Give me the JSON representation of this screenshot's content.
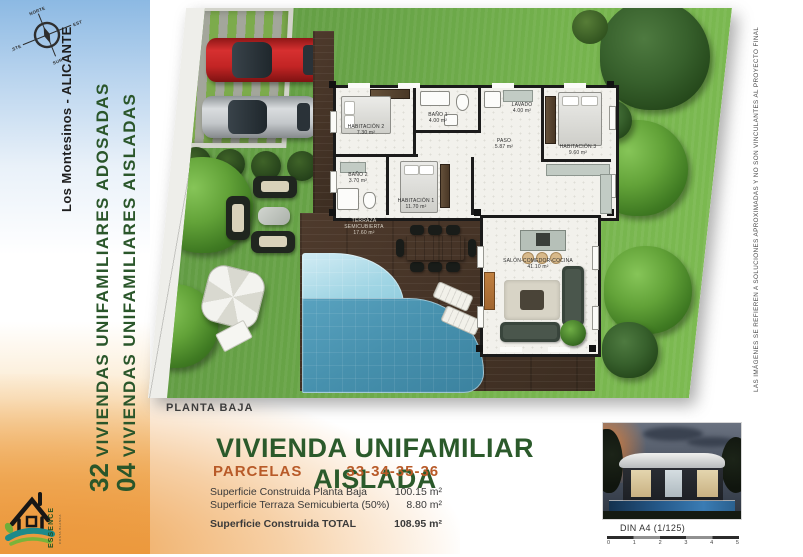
{
  "colors": {
    "title_green": "#2b5a2b",
    "parcels_orange": "#b85a28",
    "sidebar_blue": "#8cb9e3",
    "sidebar_orange": "#ec9a3f",
    "grass": "#6fae49",
    "pool_shallow": "#a0d5e4",
    "pool_deep": "#4690ad",
    "deck_wood": "#46342a",
    "red_car": "#c22424",
    "silver_car": "#c3c7ca"
  },
  "sidebar_left": {
    "compass": {
      "north": "NORTE",
      "east": "ESTE",
      "south": "SUR",
      "west": "OESTE"
    },
    "location": "Los Montesinos - ALICANTE",
    "project_lines": [
      {
        "number": "32",
        "label": "VIVIENDAS UNIFAMILIARES ADOSADAS"
      },
      {
        "number": "04",
        "label": "VIVIENDAS UNIFAMILIARES AISLADAS"
      }
    ],
    "logo": {
      "name": "ESSENCE",
      "subtitle": "COSTA BLANCA"
    }
  },
  "sidebar_right": {
    "disclaimer": "LAS IMÁGENES SE REFIEREN A SOLUCIONES APROXIMADAS Y NO SON VINCULANTES AL PROYECTO FINAL"
  },
  "plan": {
    "rooms": [
      {
        "id": "habitacion-1",
        "label": "HABITACIÓN 1",
        "area": "11.70 m²"
      },
      {
        "id": "habitacion-2",
        "label": "HABITACIÓN 2",
        "area": "7.30 m²"
      },
      {
        "id": "habitacion-3",
        "label": "HABITACIÓN 3",
        "area": "9.60 m²"
      },
      {
        "id": "bano-1",
        "label": "BAÑO 1",
        "area": "4.00 m²"
      },
      {
        "id": "bano-2",
        "label": "BAÑO 2",
        "area": "3.70 m²"
      },
      {
        "id": "lavado",
        "label": "LAVADO",
        "area": "4.00 m²"
      },
      {
        "id": "paso",
        "label": "PASO",
        "area": "5.87 m²"
      },
      {
        "id": "salon",
        "label": "SALÓN-COMEDOR-COCINA",
        "area": "41.10 m²"
      },
      {
        "id": "terraza",
        "label": "TERRAZA SEMICUBIERTA",
        "area": "17.60 m²"
      }
    ]
  },
  "footer": {
    "plan_label": "PLANTA BAJA",
    "title": "VIVIENDA UNIFAMILIAR AISLADA",
    "parcels_label": "PARCELAS",
    "parcels_value": "33-34-35-36",
    "surface_rows": [
      {
        "label": "Superficie Construida Planta Baja",
        "value": "100.15 m²"
      },
      {
        "label": "Superficie Terraza Semicubierta (50%)",
        "value": "8.80 m²"
      }
    ],
    "total_row": {
      "label": "Superficie Construida TOTAL",
      "value": "108.95 m²"
    },
    "scale_label": "DIN A4 (1/125)",
    "scale_ticks": [
      "0",
      "1",
      "2",
      "3",
      "4",
      "5"
    ]
  }
}
